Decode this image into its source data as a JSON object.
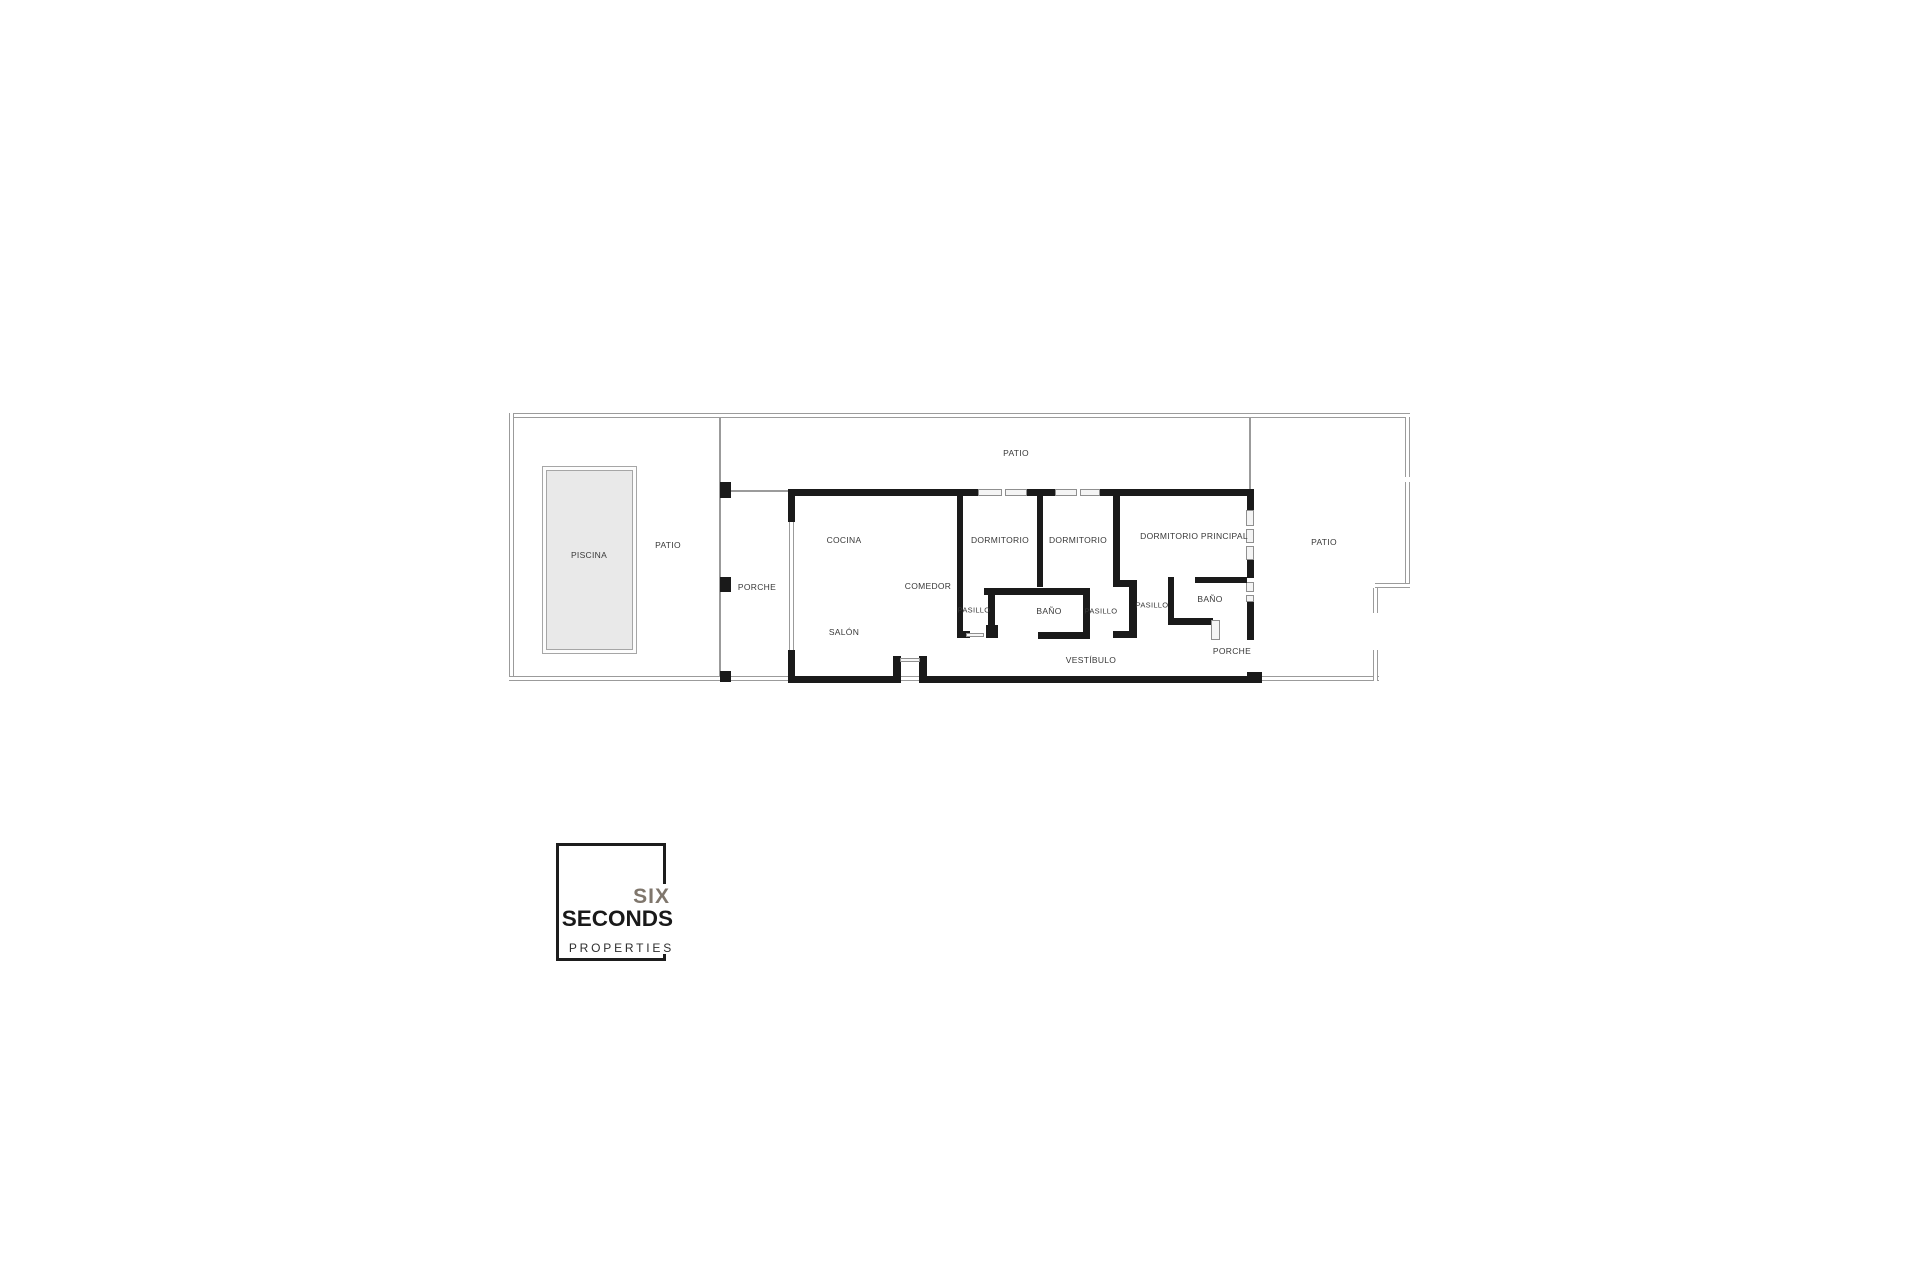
{
  "floorplan": {
    "labels": {
      "patio_top": "PATIO",
      "patio_left": "PATIO",
      "patio_right": "PATIO",
      "piscina": "PISCINA",
      "porche_left": "PORCHE",
      "porche_right": "PORCHE",
      "cocina": "COCINA",
      "comedor": "COMEDOR",
      "salon": "SALÓN",
      "dormitorio_1": "DORMITORIO",
      "dormitorio_2": "DORMITORIO",
      "dormitorio_principal": "DORMITORIO PRINCIPAL",
      "pasillo_1": "PASILLO",
      "pasillo_2": "PASILLO",
      "pasillo_3": "PASILLO",
      "banyo_1": "BAÑO",
      "banyo_2": "BAÑO",
      "vestibulo": "VESTÍBULO"
    },
    "colors": {
      "wall": "#1a1a1a",
      "boundary_line": "#9b9b9b",
      "pool_fill": "#e9e9e9",
      "label_text": "#383838"
    }
  },
  "logo": {
    "line1": "SIX",
    "line2": "SECONDS",
    "line3": "PROPERTIES",
    "accent_color": "#7f766c"
  }
}
